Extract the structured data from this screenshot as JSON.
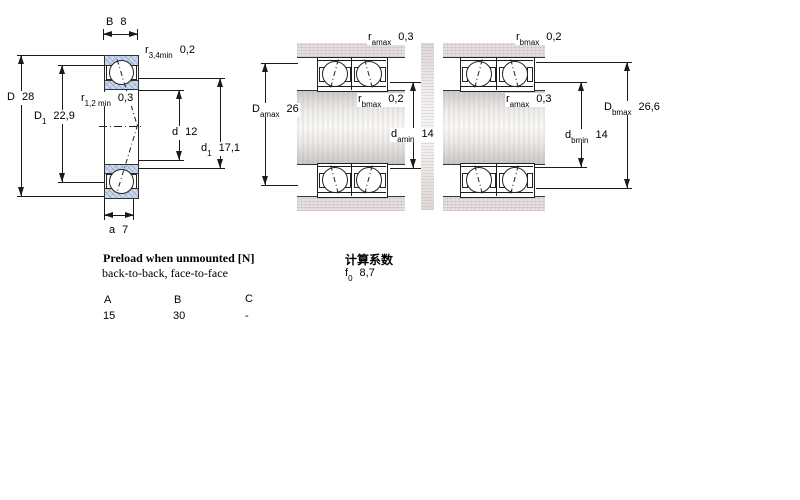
{
  "colors": {
    "line": "#1a1a1a",
    "text": "#000000",
    "ring_fill": "#ccd9ec",
    "housing_fill": "#e6e1e1",
    "shaft_light": "#f9f8f6"
  },
  "dims": {
    "B": {
      "base": "B",
      "sub": "",
      "value": "8"
    },
    "r34": {
      "base": "r",
      "sub": "3,4min",
      "value": "0,2"
    },
    "D": {
      "base": "D",
      "sub": "",
      "value": "28"
    },
    "D1": {
      "base": "D",
      "sub": "1",
      "value": "22,9"
    },
    "r12": {
      "base": "r",
      "sub": "1,2 min",
      "value": "0,3"
    },
    "d": {
      "base": "d",
      "sub": "",
      "value": "12"
    },
    "d1": {
      "base": "d",
      "sub": "1",
      "value": "17,1"
    },
    "a": {
      "base": "a",
      "sub": "",
      "value": "7"
    },
    "ramax1": {
      "base": "r",
      "sub": "amax",
      "value": "0,3"
    },
    "rbmax1": {
      "base": "r",
      "sub": "bmax",
      "value": "0,2"
    },
    "Damax": {
      "base": "D",
      "sub": "amax",
      "value": "26"
    },
    "damin": {
      "base": "d",
      "sub": "amin",
      "value": "14"
    },
    "rbmax2": {
      "base": "r",
      "sub": "bmax",
      "value": "0,2"
    },
    "ramax2": {
      "base": "r",
      "sub": "amax",
      "value": "0,3"
    },
    "Dbmax": {
      "base": "D",
      "sub": "bmax",
      "value": "26,6"
    },
    "dbmin": {
      "base": "d",
      "sub": "bmin",
      "value": "14"
    }
  },
  "preload": {
    "title": "Preload when unmounted [N]",
    "subtitle": "back-to-back, face-to-face",
    "col_a": "A",
    "col_b": "B",
    "col_c": "C",
    "val_a": "15",
    "val_b": "30",
    "val_c": "-"
  },
  "calc": {
    "title": "计算系数",
    "f0_base": "f",
    "f0_sub": "0",
    "f0_value": "8,7"
  }
}
